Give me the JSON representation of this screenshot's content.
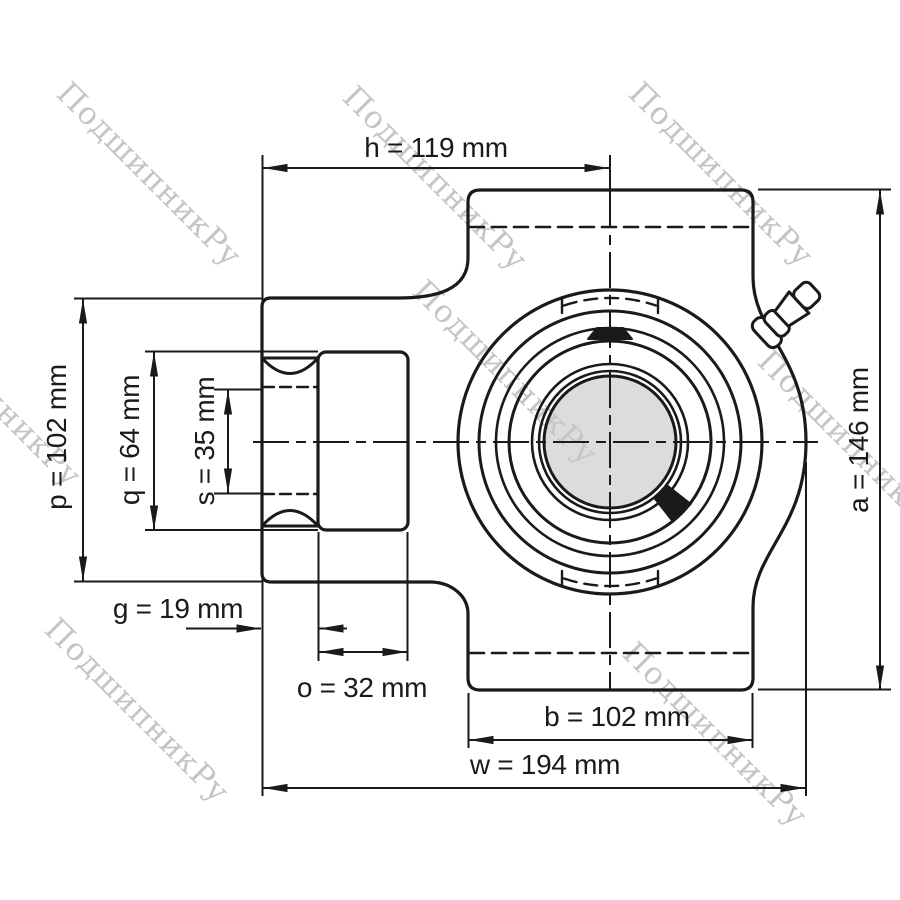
{
  "watermark": {
    "text": "ПодшипникРу",
    "color": "#c5c5c5"
  },
  "colors": {
    "line": "#1a1a1a",
    "bore_fill": "#dcdcdc",
    "background": "#ffffff"
  },
  "drawing_subject": "take-up bearing unit, front and side profile with grease fitting",
  "dimensions": {
    "h": {
      "label": "h",
      "value": 119,
      "unit": "mm",
      "text": "h = 119 mm"
    },
    "p": {
      "label": "p",
      "value": 102,
      "unit": "mm",
      "text": "p = 102 mm"
    },
    "q": {
      "label": "q",
      "value": 64,
      "unit": "mm",
      "text": "q = 64 mm"
    },
    "s": {
      "label": "s",
      "value": 35,
      "unit": "mm",
      "text": "s = 35 mm"
    },
    "g": {
      "label": "g",
      "value": 19,
      "unit": "mm",
      "text": "g = 19 mm"
    },
    "o": {
      "label": "o",
      "value": 32,
      "unit": "mm",
      "text": "o = 32 mm"
    },
    "b": {
      "label": "b",
      "value": 102,
      "unit": "mm",
      "text": "b = 102 mm"
    },
    "w": {
      "label": "w",
      "value": 194,
      "unit": "mm",
      "text": "w = 194 mm"
    },
    "a": {
      "label": "a",
      "value": 146,
      "unit": "mm",
      "text": "a = 146 mm"
    }
  }
}
